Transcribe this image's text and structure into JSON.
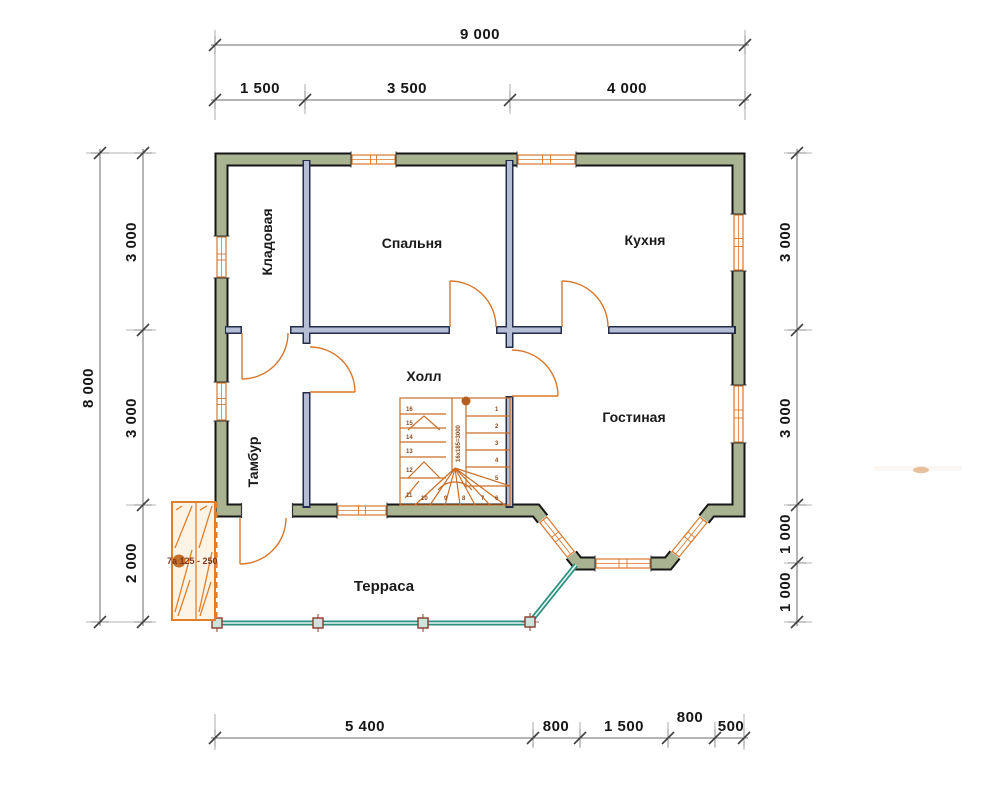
{
  "plan": {
    "rooms": {
      "storage": "Кладовая",
      "bedroom": "Спальня",
      "kitchen": "Кухня",
      "hall": "Холл",
      "vestibule": "Тамбур",
      "living": "Гостиная",
      "terrace": "Терраса"
    },
    "dims": {
      "top_total": "9 000",
      "top": [
        "1 500",
        "3 500",
        "4 000"
      ],
      "left_total": "8 000",
      "left": [
        "3 000",
        "3 000",
        "2 000"
      ],
      "right": [
        "3 000",
        "3 000",
        "1 000",
        "1 000"
      ],
      "bottom": [
        "5 400",
        "800",
        "1 500",
        "800",
        "500"
      ]
    },
    "stair": {
      "right": [
        "1",
        "2",
        "3",
        "4",
        "5",
        "6"
      ],
      "left": [
        "16",
        "15",
        "14",
        "13",
        "12",
        "11"
      ],
      "bottom": [
        "10",
        "9",
        "8",
        "7"
      ],
      "note": "16x185=3000"
    },
    "porch": {
      "label": "7а 125 - 250"
    },
    "colors": {
      "exterior_wall": "#a9b291",
      "interior_wall": "#b5bdd5",
      "joinery_orange": "#d9782d",
      "railing_teal": "#2e8f7f",
      "dim_line": "#6b6b6b",
      "text": "#161616"
    }
  }
}
